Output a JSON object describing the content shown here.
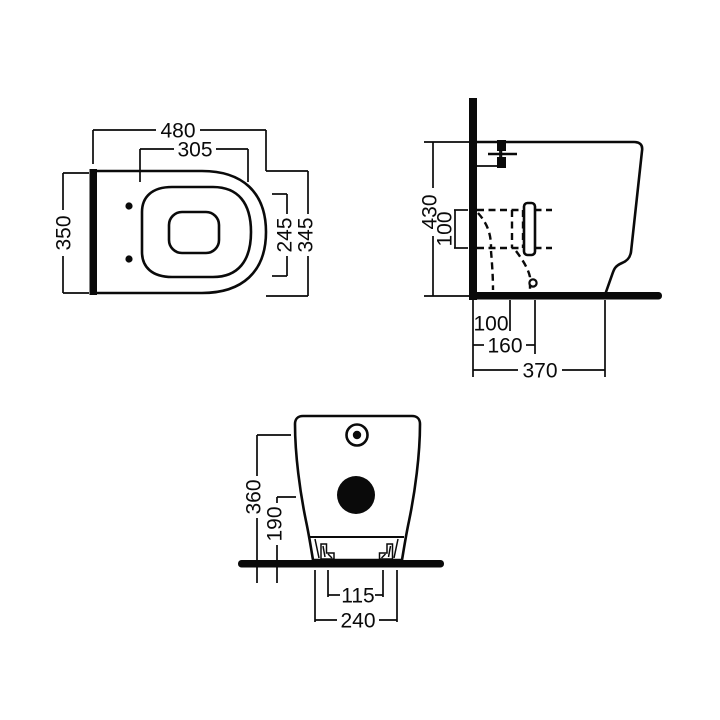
{
  "drawing_title": "toilet-technical-dimension-drawing",
  "colors": {
    "ink": "#0a0a0a",
    "background": "#ffffff"
  },
  "views": {
    "top": {
      "dims": {
        "overall_width": "480",
        "seat_width": "305",
        "overall_depth": "350",
        "seat_depth": "245",
        "rim_depth": "345"
      }
    },
    "side": {
      "dims": {
        "overall_height": "430",
        "outlet_diameter": "100",
        "outlet_floor_offset": "100",
        "outlet_wall_distance": "160",
        "overall_depth": "370"
      }
    },
    "front": {
      "dims": {
        "inlet_height": "360",
        "drain_height": "190",
        "fixing_hole_spacing": "115",
        "base_width": "240"
      }
    }
  }
}
